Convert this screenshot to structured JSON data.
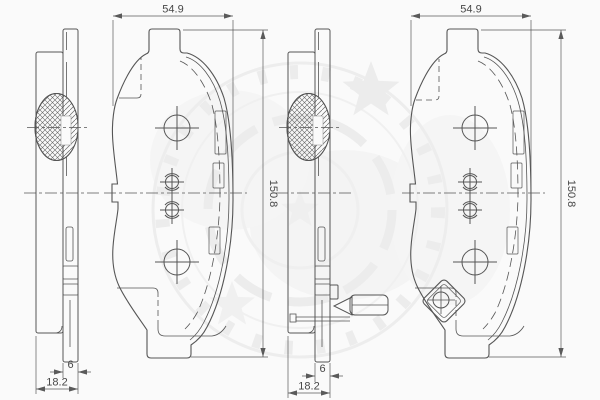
{
  "drawing": {
    "background": "#fafafa",
    "line_color": "#555555",
    "text_color": "#474747",
    "watermark_color": "#ececec",
    "dims": {
      "left_pad": {
        "width": "54.9",
        "height": "150.8",
        "plate_thickness": "6",
        "total_thickness": "18.2"
      },
      "right_pad": {
        "width": "54.9",
        "height": "150.8",
        "plate_thickness": "6",
        "total_thickness": "18.2"
      }
    }
  }
}
